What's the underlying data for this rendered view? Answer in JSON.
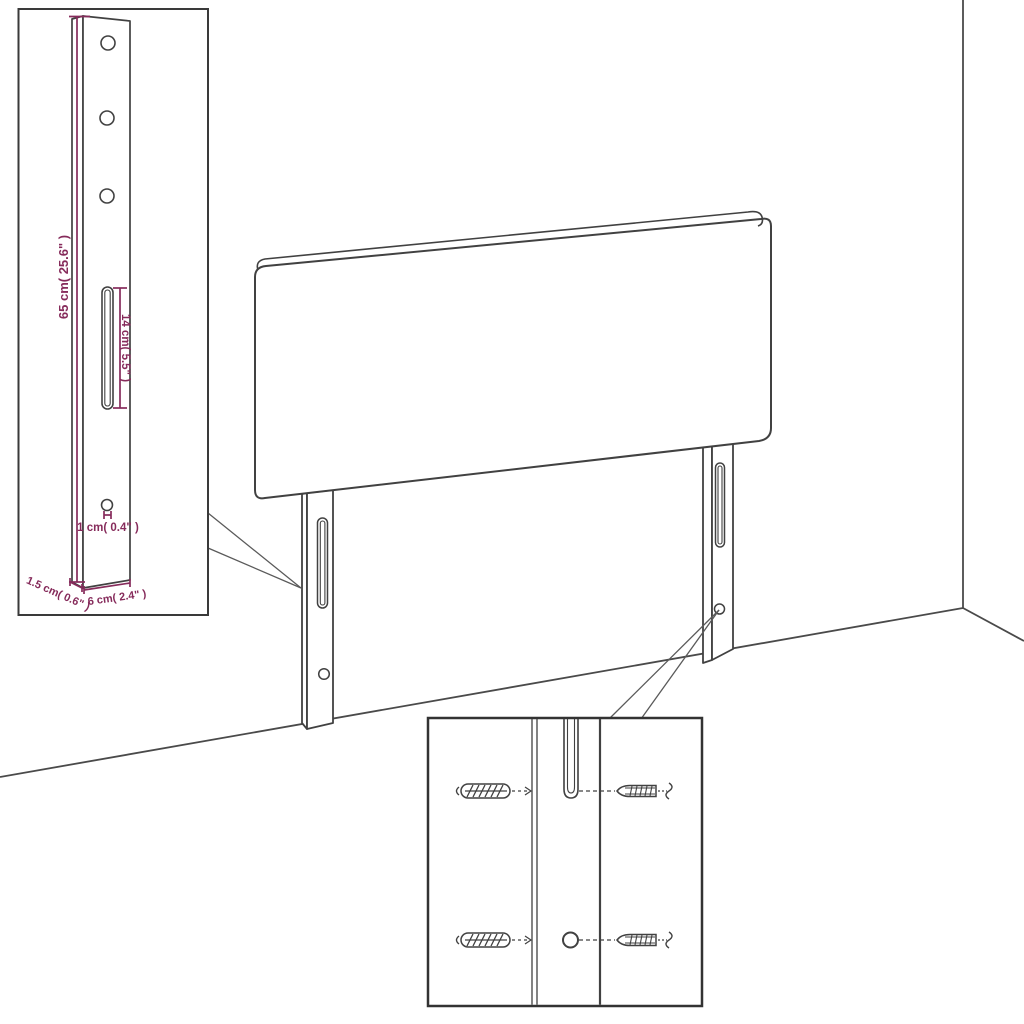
{
  "colors": {
    "outline": "#414141",
    "dimension": "#862B5B",
    "background": "#FFFFFF"
  },
  "leg_detail_inset": {
    "dimensions": {
      "height": "65 cm( 25.6\" )",
      "slot_length": "14 cm( 5.5\" )",
      "hole_diameter": "1 cm( 0.4\" )",
      "side_depth": "1.5 cm( 0.6\" )",
      "leg_width": "6 cm( 2.4\" )"
    }
  },
  "mounting_detail_inset": {
    "parts": {
      "left": "wall-plug-icon",
      "right": "screw-icon"
    }
  }
}
